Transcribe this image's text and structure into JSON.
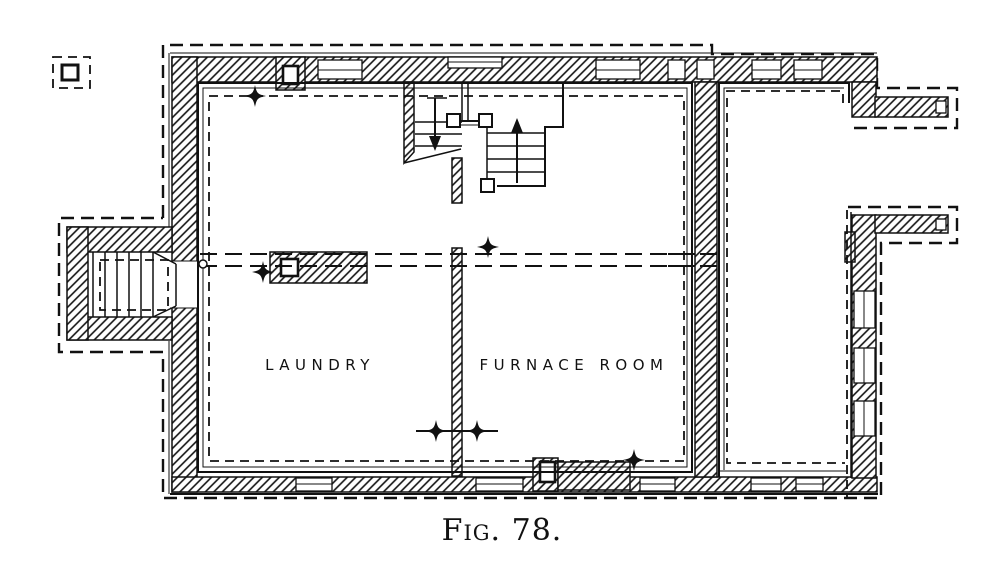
{
  "figure": {
    "caption": "Fig. 78."
  },
  "rooms": {
    "laundry": "LAUNDRY",
    "furnace": "FURNACE ROOM"
  },
  "colors": {
    "ink": "#111111",
    "paper": "#ffffff"
  },
  "symbols": {
    "column_marker": "four-pointed-star",
    "wall_fill": "diagonal-hatch",
    "foundation_outline": "dashed-line"
  }
}
